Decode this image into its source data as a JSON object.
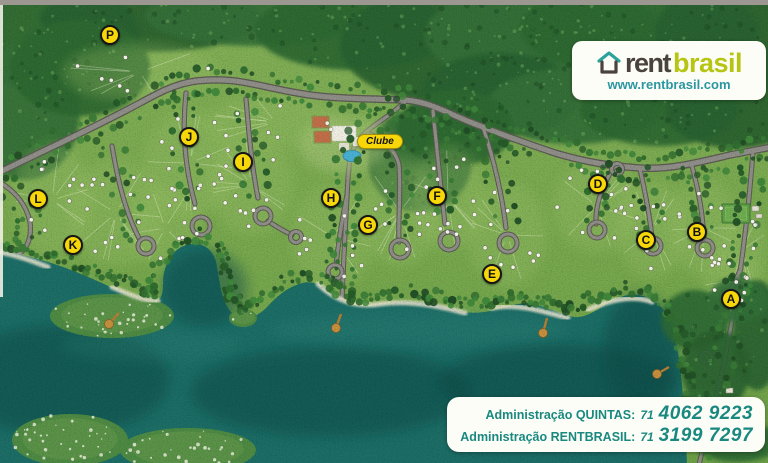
{
  "logo": {
    "brand_primary": "rent",
    "brand_secondary": "brasil",
    "website": "www.rentbrasil.com"
  },
  "map": {
    "clube_label": "Clube",
    "markers": [
      {
        "letter": "A"
      },
      {
        "letter": "B"
      },
      {
        "letter": "C"
      },
      {
        "letter": "D"
      },
      {
        "letter": "E"
      },
      {
        "letter": "F"
      },
      {
        "letter": "G"
      },
      {
        "letter": "H"
      },
      {
        "letter": "I"
      },
      {
        "letter": "J"
      },
      {
        "letter": "K"
      },
      {
        "letter": "L"
      },
      {
        "letter": "P"
      }
    ]
  },
  "admin_panel": {
    "lines": [
      {
        "label": "Administração QUINTAS:",
        "area_code": "71",
        "phone": "4062 9223"
      },
      {
        "label": "Administração RENTBRASIL:",
        "area_code": "71",
        "phone": "3199 7297"
      }
    ]
  },
  "colors": {
    "accent_yellow": "#f7d708",
    "brand_dark": "#4a423c",
    "brand_lime": "#b6c513",
    "teal_text": "#19897f",
    "url_teal": "#2a96a0",
    "water": "#1d6f68",
    "grass": "#79a950"
  }
}
